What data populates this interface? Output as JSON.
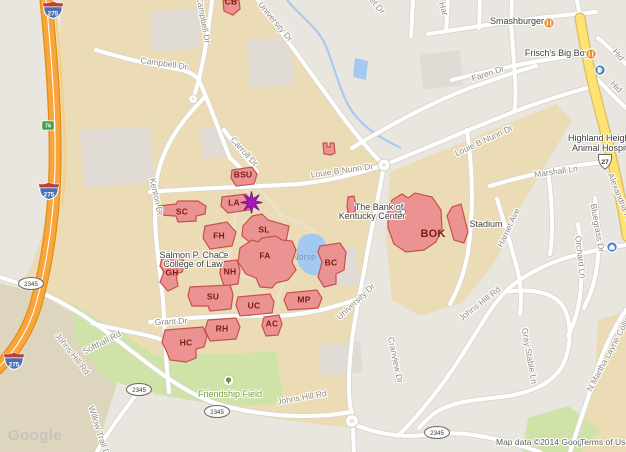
{
  "shields": {
    "interstate": "275",
    "exit_badge": "76",
    "us_route": "27",
    "state_route": "2345"
  },
  "buildings": [
    {
      "id": "cb",
      "label": "CB"
    },
    {
      "id": "bsu",
      "label": "BSU"
    },
    {
      "id": "sc",
      "label": "SC"
    },
    {
      "id": "la",
      "label": "LA"
    },
    {
      "id": "fh",
      "label": "FH"
    },
    {
      "id": "sl",
      "label": "SL"
    },
    {
      "id": "fa",
      "label": "FA"
    },
    {
      "id": "nh",
      "label": "NH"
    },
    {
      "id": "gh",
      "label": "GH"
    },
    {
      "id": "bc",
      "label": "BC"
    },
    {
      "id": "su",
      "label": "SU"
    },
    {
      "id": "uc",
      "label": "UC"
    },
    {
      "id": "mp",
      "label": "MP"
    },
    {
      "id": "ac",
      "label": "AC"
    },
    {
      "id": "rh",
      "label": "RH"
    },
    {
      "id": "hc",
      "label": "HC"
    },
    {
      "id": "bok",
      "label": "BOK"
    },
    {
      "id": "stadium",
      "label": "Stadium"
    }
  ],
  "roads": {
    "university_dr": "University Dr",
    "campbell_dr": "Campbell Dr",
    "carroll_dr": "Carroll Dr",
    "kenton_dr": "Kenton Dr",
    "louie_b_nunn_dr": "Louie B Nunn Dr",
    "faren_dr": "Faren Dr",
    "marshall_ln": "Marshall Ln",
    "alexandria_pike": "Alexandria Pike",
    "harriet_ave": "Harriet Ave",
    "bluegrass_dr": "Bluegrass Dr",
    "orchard_ln": "Orchard Ln",
    "johns_hill_rd": "Johns Hill Rd",
    "softball_rd": "Softball Rd",
    "grant_dr": "Grant Dr",
    "willow_trail_dr": "Willow Trail Dr",
    "gray_stable_ln": "Gray Stable Ln",
    "martha_layne_collins": "N Martha Layne Collins",
    "cranview_dr": "Cranview Dr",
    "partial_et_dr": "et Dr",
    "partial_har": "Har",
    "partial_hid": "Hid"
  },
  "pois": {
    "smashburger": "Smashburger",
    "frischs_big_boy": "Frisch's Big Boy",
    "animal_hospital_line1": "Highland Heights",
    "animal_hospital_line2": "Animal Hospital",
    "bank_of_kentucky_line1": "The Bank of",
    "bank_of_kentucky_line2": "Kentucky Center",
    "chase_law_line1": "Salmon P. Chase",
    "chase_law_line2": "College of Law",
    "friendship_field": "Friendship Field",
    "loch_norse": "Loch Norse"
  },
  "marker": {
    "type": "star",
    "color": "#a31bb5"
  },
  "attribution": {
    "logo": "Google",
    "map_data": "Map data ©2014 Google",
    "terms": "Terms of Use"
  },
  "colors": {
    "campus_tan": "#ebdcb6",
    "building_fill": "#eb9392",
    "building_border": "#c9504b",
    "freeway_orange": "#f9a53c",
    "highway_yellow": "#ffe372",
    "water_blue": "#a3c9f1",
    "park_green": "#cfe3a8"
  }
}
